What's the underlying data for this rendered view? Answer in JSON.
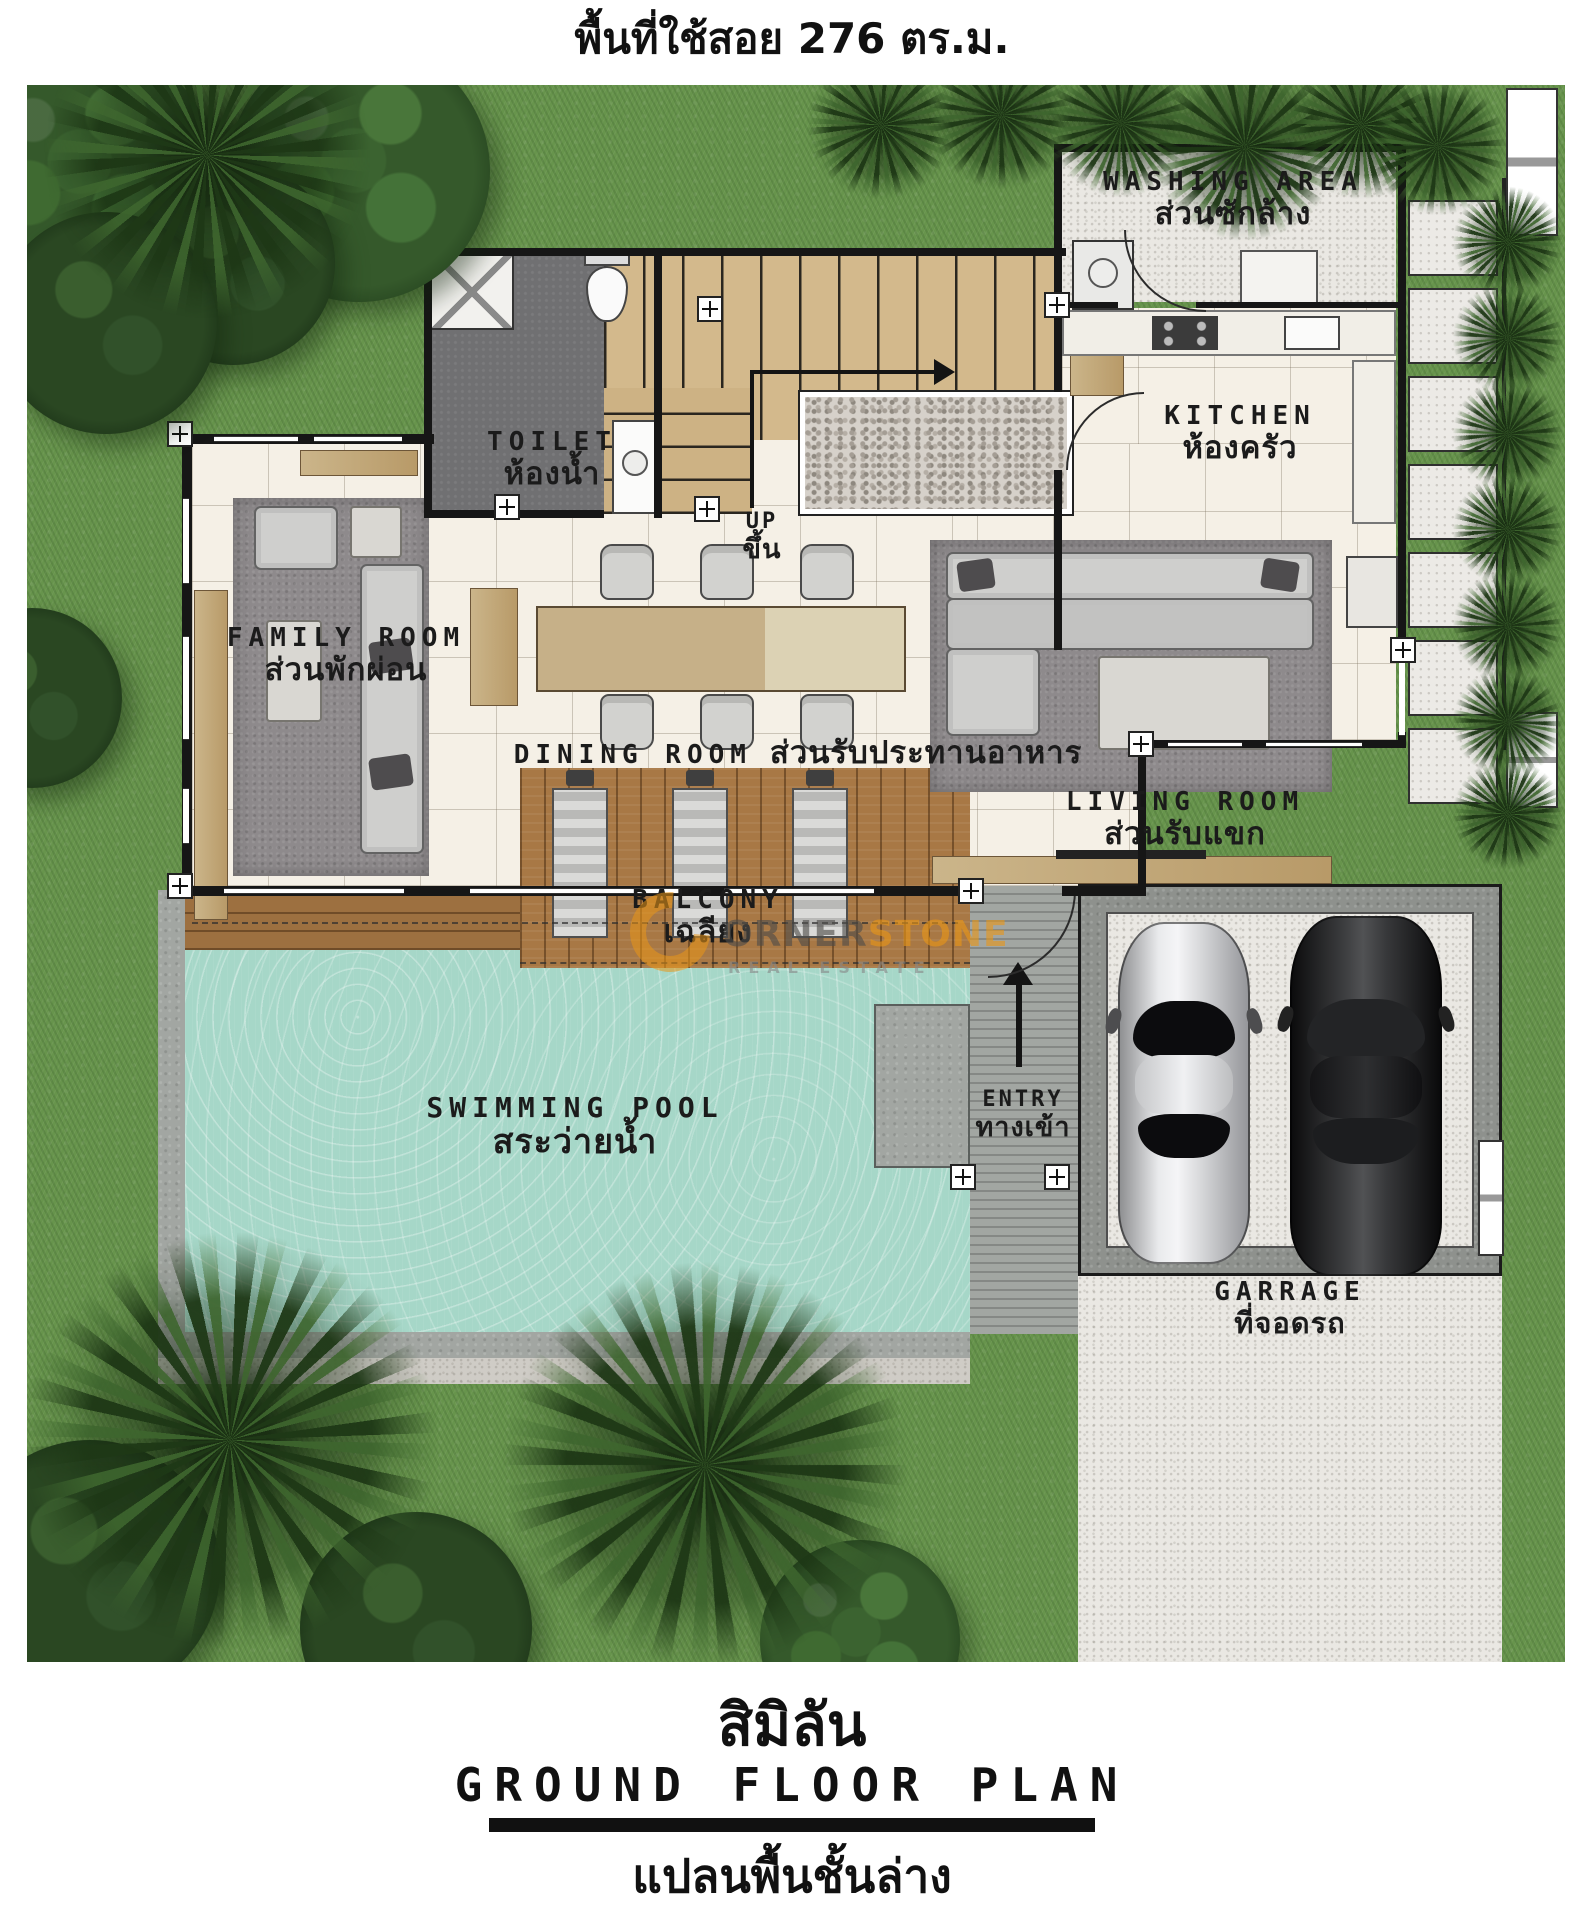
{
  "page": {
    "area_label": "พื้นที่ใช้สอย 276 ตร.ม."
  },
  "rooms": {
    "washing_area": {
      "en": "WASHING AREA",
      "th": "ส่วนซักล้าง"
    },
    "kitchen": {
      "en": "KITCHEN",
      "th": "ห้องครัว"
    },
    "toilet": {
      "en": "TOILET",
      "th": "ห้องน้ำ"
    },
    "stairs_up": {
      "en": "UP",
      "th": "ขึ้น"
    },
    "family_room": {
      "en": "FAMILY ROOM",
      "th": "ส่วนพักผ่อน"
    },
    "dining_room": {
      "en": "DINING ROOM",
      "th": "ส่วนรับประทานอาหาร"
    },
    "living_room": {
      "en": "LIVING ROOM",
      "th": "ส่วนรับแขก"
    },
    "balcony": {
      "en": "BALCONY",
      "th": "เฉลียง"
    },
    "swimming_pool": {
      "en": "SWIMMING POOL",
      "th": "สระว่ายน้ำ"
    },
    "entry": {
      "en": "ENTRY",
      "th": "ทางเข้า"
    },
    "garage": {
      "en": "GARRAGE",
      "th": "ที่จอดรถ"
    }
  },
  "watermark": {
    "name_gray": "ORNER",
    "name_orange": "STONE",
    "tagline": "REAL ESTATE"
  },
  "footer": {
    "project_name": "สิมิลัน",
    "plan_title_en": "GROUND FLOOR PLAN",
    "plan_title_th": "แปลนพื้นชั้นล่าง"
  },
  "colors": {
    "grass": "#67944c",
    "pool_water": "#a6d7c8",
    "deck_wood": "#a87845",
    "floor_tile": "#f5f0e6",
    "concrete": "#a2a6a2",
    "wall": "#161616",
    "watermark_orange": "#e99616"
  }
}
